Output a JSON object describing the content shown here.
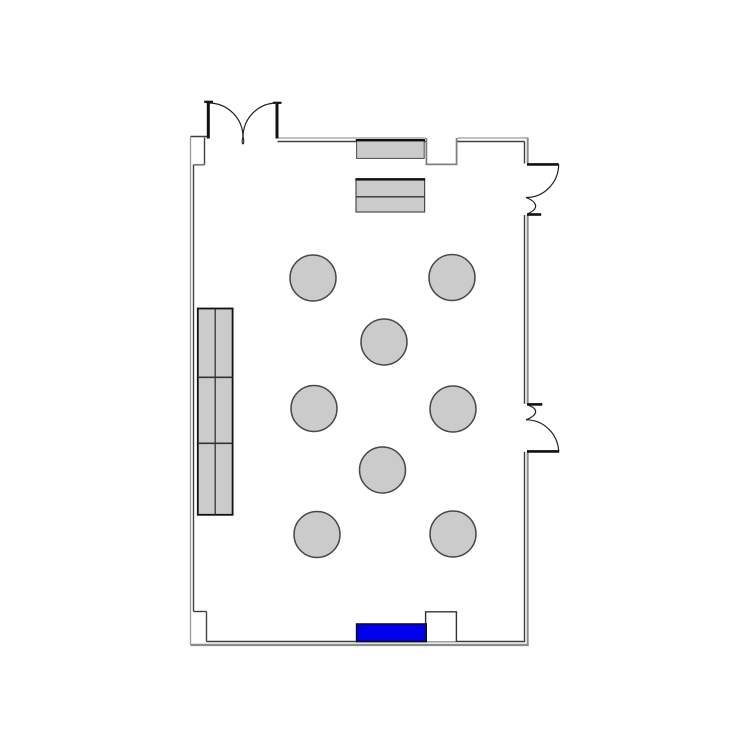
{
  "canvas": {
    "width": 750,
    "height": 750,
    "background": "#ffffff"
  },
  "colors": {
    "wall_dark": "#3f3f3f",
    "wall_outer": "#9a9a9a",
    "wall_outer_thick": "#8b8b8b",
    "notch_gray": "#808080",
    "edge_black": "#111111",
    "door_stroke": "#222222",
    "furniture_fill": "#cbcbcb",
    "furniture_stroke": "#4a4a4a",
    "divider": "#333333",
    "highlight_blue": "#0000ec",
    "white": "#ffffff"
  },
  "plan": {
    "elements": [
      {
        "name": "wall-left-outer",
        "kind": "line",
        "interactable": false,
        "attrs": {
          "x1": 190.5,
          "y1": 136.5,
          "x2": 190.5,
          "y2": 644.8,
          "stroke": "$wall_outer",
          "stroke-width": 1.3
        }
      },
      {
        "name": "wall-top-step-cap",
        "kind": "line",
        "interactable": false,
        "attrs": {
          "x1": 190.5,
          "y1": 136.5,
          "x2": 207.5,
          "y2": 136.5,
          "stroke": "$wall_dark",
          "stroke-width": 1.4
        }
      },
      {
        "name": "wall-top-step-inner-vertical",
        "kind": "line",
        "interactable": false,
        "attrs": {
          "x1": 204.5,
          "y1": 137.5,
          "x2": 204.5,
          "y2": 164.8,
          "stroke": "$wall_dark",
          "stroke-width": 1.4
        }
      },
      {
        "name": "wall-top-step-inner-horizontal",
        "kind": "line",
        "interactable": false,
        "attrs": {
          "x1": 193.5,
          "y1": 164.8,
          "x2": 204.5,
          "y2": 164.8,
          "stroke": "$notch_gray",
          "stroke-width": 1.8
        }
      },
      {
        "name": "wall-left-inner",
        "kind": "line",
        "interactable": false,
        "attrs": {
          "x1": 193.5,
          "y1": 164.8,
          "x2": 193.5,
          "y2": 611.5,
          "stroke": "$wall_dark",
          "stroke-width": 1.4
        }
      },
      {
        "name": "wall-bottom-step-horizontal",
        "kind": "line",
        "interactable": false,
        "attrs": {
          "x1": 193.5,
          "y1": 611.5,
          "x2": 206.5,
          "y2": 611.5,
          "stroke": "$wall_dark",
          "stroke-width": 1.4
        }
      },
      {
        "name": "wall-bottom-step-vertical",
        "kind": "line",
        "interactable": false,
        "attrs": {
          "x1": 206.5,
          "y1": 611.5,
          "x2": 206.5,
          "y2": 641.5,
          "stroke": "$wall_dark",
          "stroke-width": 1.4
        }
      },
      {
        "name": "wall-bottom-inner",
        "kind": "line",
        "interactable": false,
        "attrs": {
          "x1": 206.5,
          "y1": 641.5,
          "x2": 525.2,
          "y2": 641.5,
          "stroke": "$wall_dark",
          "stroke-width": 1.4
        }
      },
      {
        "name": "wall-bottom-outer",
        "kind": "line",
        "interactable": false,
        "attrs": {
          "x1": 190.5,
          "y1": 644.9,
          "x2": 528.7,
          "y2": 644.9,
          "stroke": "$wall_outer_thick",
          "stroke-width": 2.4
        }
      },
      {
        "name": "wall-top-outer-left-span",
        "kind": "line",
        "interactable": false,
        "attrs": {
          "x1": 277.5,
          "y1": 138.0,
          "x2": 425.5,
          "y2": 138.0,
          "stroke": "$wall_outer",
          "stroke-width": 1.3
        }
      },
      {
        "name": "wall-top-outer-right-span",
        "kind": "line",
        "interactable": false,
        "attrs": {
          "x1": 457.5,
          "y1": 138.0,
          "x2": 528.6,
          "y2": 138.0,
          "stroke": "$wall_outer",
          "stroke-width": 1.3
        }
      },
      {
        "name": "wall-top-inner-left-span",
        "kind": "line",
        "interactable": false,
        "attrs": {
          "x1": 277.5,
          "y1": 141.5,
          "x2": 425.5,
          "y2": 141.5,
          "stroke": "$wall_dark",
          "stroke-width": 1.4
        }
      },
      {
        "name": "wall-top-inner-right-span",
        "kind": "line",
        "interactable": false,
        "attrs": {
          "x1": 457.5,
          "y1": 141.5,
          "x2": 524.5,
          "y2": 141.5,
          "stroke": "$wall_dark",
          "stroke-width": 1.4
        }
      },
      {
        "name": "wall-right-inner-upper",
        "kind": "line",
        "interactable": false,
        "attrs": {
          "x1": 524.5,
          "y1": 141.5,
          "x2": 524.5,
          "y2": 163.5,
          "stroke": "$wall_dark",
          "stroke-width": 1.4
        }
      },
      {
        "name": "wall-right-inner-middle",
        "kind": "line",
        "interactable": false,
        "attrs": {
          "x1": 524.5,
          "y1": 215.0,
          "x2": 524.5,
          "y2": 403.8,
          "stroke": "$wall_dark",
          "stroke-width": 1.4
        }
      },
      {
        "name": "wall-right-inner-lower",
        "kind": "line",
        "interactable": false,
        "attrs": {
          "x1": 524.5,
          "y1": 451.8,
          "x2": 524.5,
          "y2": 641.5,
          "stroke": "$wall_dark",
          "stroke-width": 1.4
        }
      },
      {
        "name": "wall-right-outer-upper",
        "kind": "line",
        "interactable": false,
        "attrs": {
          "x1": 527.7,
          "y1": 138.0,
          "x2": 527.7,
          "y2": 163.5,
          "stroke": "$wall_outer_thick",
          "stroke-width": 2.0
        }
      },
      {
        "name": "wall-right-outer-middle",
        "kind": "line",
        "interactable": false,
        "attrs": {
          "x1": 527.7,
          "y1": 215.0,
          "x2": 527.7,
          "y2": 403.8,
          "stroke": "$wall_outer_thick",
          "stroke-width": 2.0
        }
      },
      {
        "name": "wall-right-outer-lower",
        "kind": "line",
        "interactable": false,
        "attrs": {
          "x1": 527.7,
          "y1": 451.8,
          "x2": 527.7,
          "y2": 644.9,
          "stroke": "$wall_outer_thick",
          "stroke-width": 2.0
        }
      },
      {
        "name": "wall-notch-top",
        "kind": "path",
        "interactable": false,
        "attrs": {
          "d": "M 426.4,138 L 426.4,164.4 L 456.6,164.4 L 456.6,138",
          "fill": "$white",
          "stroke": "$notch_gray",
          "stroke-width": 1.8
        }
      },
      {
        "name": "wall-notch-bottom",
        "kind": "path",
        "interactable": false,
        "attrs": {
          "d": "M 425.6,641.5 L 425.6,611.8 L 456.4,611.8 L 456.4,641.5",
          "fill": "$white",
          "stroke": "$divider",
          "stroke-width": 1.4
        }
      },
      {
        "name": "double-door-left-jamb",
        "kind": "line",
        "interactable": true,
        "attrs": {
          "x1": 208.3,
          "y1": 101.5,
          "x2": 208.3,
          "y2": 138.5,
          "stroke": "$edge_black",
          "stroke-width": 3.0
        }
      },
      {
        "name": "double-door-left-jamb-cap",
        "kind": "line",
        "interactable": false,
        "attrs": {
          "x1": 204.2,
          "y1": 101.8,
          "x2": 213.0,
          "y2": 101.8,
          "stroke": "$edge_black",
          "stroke-width": 2.2
        }
      },
      {
        "name": "double-door-right-jamb",
        "kind": "line",
        "interactable": true,
        "attrs": {
          "x1": 277.0,
          "y1": 102.5,
          "x2": 277.0,
          "y2": 138.5,
          "stroke": "$edge_black",
          "stroke-width": 3.0
        }
      },
      {
        "name": "double-door-right-jamb-cap",
        "kind": "line",
        "interactable": false,
        "attrs": {
          "x1": 272.8,
          "y1": 102.8,
          "x2": 281.5,
          "y2": 102.8,
          "stroke": "$edge_black",
          "stroke-width": 2.2
        }
      },
      {
        "name": "double-door-left-swing-arc",
        "kind": "path",
        "interactable": false,
        "attrs": {
          "d": "M 208.5,103 A 34.5,34 0 0 1 243,137",
          "fill": "none",
          "stroke": "$door_stroke",
          "stroke-width": 1.2
        }
      },
      {
        "name": "double-door-right-swing-arc",
        "kind": "path",
        "interactable": false,
        "attrs": {
          "d": "M 277,103 A 34,34 0 0 0 243,137",
          "fill": "none",
          "stroke": "$door_stroke",
          "stroke-width": 1.2
        }
      },
      {
        "name": "double-door-cusp-tail-left",
        "kind": "path",
        "interactable": false,
        "attrs": {
          "d": "M 243,136.5 Q 241.7,140.5 242.5,144.2",
          "fill": "none",
          "stroke": "$door_stroke",
          "stroke-width": 1.1
        }
      },
      {
        "name": "double-door-cusp-tail-right",
        "kind": "path",
        "interactable": false,
        "attrs": {
          "d": "M 243,136.5 Q 244.3,140.5 243.3,144.2",
          "fill": "none",
          "stroke": "$door_stroke",
          "stroke-width": 1.1
        }
      },
      {
        "name": "door-upper-right-leaf",
        "kind": "line",
        "interactable": true,
        "attrs": {
          "x1": 527.0,
          "y1": 164.4,
          "x2": 558.7,
          "y2": 164.4,
          "stroke": "$edge_black",
          "stroke-width": 2.6
        }
      },
      {
        "name": "door-upper-right-swing-arc",
        "kind": "path",
        "interactable": false,
        "attrs": {
          "d": "M 558.7,164.4 A 32.5,33.5 0 0 1 526,197.5",
          "fill": "none",
          "stroke": "$door_stroke",
          "stroke-width": 1.2
        }
      },
      {
        "name": "door-upper-right-hook",
        "kind": "path",
        "interactable": false,
        "attrs": {
          "d": "M 526,197.5 C 536.5,201.5 540,208 528.3,213.6",
          "fill": "none",
          "stroke": "$door_stroke",
          "stroke-width": 1.2
        }
      },
      {
        "name": "door-upper-right-jamb-cap",
        "kind": "line",
        "interactable": false,
        "attrs": {
          "x1": 527.0,
          "y1": 214.5,
          "x2": 541.2,
          "y2": 214.5,
          "stroke": "$edge_black",
          "stroke-width": 2.6
        }
      },
      {
        "name": "door-lower-right-jamb-cap",
        "kind": "line",
        "interactable": false,
        "attrs": {
          "x1": 527.0,
          "y1": 404.4,
          "x2": 542.3,
          "y2": 404.4,
          "stroke": "$edge_black",
          "stroke-width": 2.6
        }
      },
      {
        "name": "door-lower-right-hook",
        "kind": "path",
        "interactable": false,
        "attrs": {
          "d": "M 526,419.8 C 536.5,415.8 540,409.5 528.3,405.2",
          "fill": "none",
          "stroke": "$door_stroke",
          "stroke-width": 1.2
        }
      },
      {
        "name": "door-lower-right-swing-arc",
        "kind": "path",
        "interactable": false,
        "attrs": {
          "d": "M 558.7,451 A 32.5,33.5 0 0 0 526,419.8",
          "fill": "none",
          "stroke": "$door_stroke",
          "stroke-width": 1.2
        }
      },
      {
        "name": "door-lower-right-leaf",
        "kind": "line",
        "interactable": true,
        "attrs": {
          "x1": 527.0,
          "y1": 451.4,
          "x2": 559.2,
          "y2": 451.4,
          "stroke": "$edge_black",
          "stroke-width": 2.6
        }
      },
      {
        "name": "shelf-unit-left",
        "kind": "rect",
        "interactable": true,
        "attrs": {
          "x": 197.8,
          "y": 308.5,
          "width": 34.8,
          "height": 206.3,
          "fill": "$furniture_fill",
          "stroke": "$edge_black",
          "stroke-width": 1.8
        }
      },
      {
        "name": "shelf-unit-left-divider-vertical",
        "kind": "line",
        "interactable": false,
        "attrs": {
          "x1": 215.2,
          "y1": 309.0,
          "x2": 215.2,
          "y2": 514.5,
          "stroke": "$divider",
          "stroke-width": 1.3
        }
      },
      {
        "name": "shelf-unit-left-divider-h1",
        "kind": "line",
        "interactable": false,
        "attrs": {
          "x1": 198.0,
          "y1": 377.3,
          "x2": 232.6,
          "y2": 377.3,
          "stroke": "$divider",
          "stroke-width": 1.6
        }
      },
      {
        "name": "shelf-unit-left-divider-h2",
        "kind": "line",
        "interactable": false,
        "attrs": {
          "x1": 198.0,
          "y1": 443.3,
          "x2": 232.6,
          "y2": 443.3,
          "stroke": "$divider",
          "stroke-width": 1.6
        }
      },
      {
        "name": "counter-top-wall",
        "kind": "rect",
        "interactable": true,
        "attrs": {
          "x": 356.6,
          "y": 140.8,
          "width": 67.6,
          "height": 17.6,
          "fill": "$furniture_fill",
          "stroke": "$furniture_stroke",
          "stroke-width": 1.0
        }
      },
      {
        "name": "counter-top-wall-edge",
        "kind": "line",
        "interactable": false,
        "attrs": {
          "x1": 355.8,
          "y1": 140.2,
          "x2": 425.0,
          "y2": 140.2,
          "stroke": "$edge_black",
          "stroke-width": 2.4
        }
      },
      {
        "name": "cabinet-freestanding",
        "kind": "rect",
        "interactable": true,
        "attrs": {
          "x": 356.0,
          "y": 180.0,
          "width": 68.6,
          "height": 32.0,
          "fill": "$furniture_fill",
          "stroke": "$furniture_stroke",
          "stroke-width": 1.2
        }
      },
      {
        "name": "cabinet-freestanding-edge",
        "kind": "line",
        "interactable": false,
        "attrs": {
          "x1": 355.4,
          "y1": 179.3,
          "x2": 425.2,
          "y2": 179.3,
          "stroke": "$edge_black",
          "stroke-width": 2.4
        }
      },
      {
        "name": "cabinet-freestanding-divider",
        "kind": "line",
        "interactable": false,
        "attrs": {
          "x1": 356.0,
          "y1": 196.8,
          "x2": 424.6,
          "y2": 196.8,
          "stroke": "$divider",
          "stroke-width": 1.3
        }
      },
      {
        "name": "table-1",
        "kind": "circle",
        "interactable": true,
        "attrs": {
          "cx": 313.0,
          "cy": 278.0,
          "r": 23,
          "fill": "$furniture_fill",
          "stroke": "$furniture_stroke",
          "stroke-width": 1.5
        }
      },
      {
        "name": "table-2",
        "kind": "circle",
        "interactable": true,
        "attrs": {
          "cx": 452.0,
          "cy": 277.5,
          "r": 23,
          "fill": "$furniture_fill",
          "stroke": "$furniture_stroke",
          "stroke-width": 1.5
        }
      },
      {
        "name": "table-3",
        "kind": "circle",
        "interactable": true,
        "attrs": {
          "cx": 384.0,
          "cy": 342.0,
          "r": 23,
          "fill": "$furniture_fill",
          "stroke": "$furniture_stroke",
          "stroke-width": 1.5
        }
      },
      {
        "name": "table-4",
        "kind": "circle",
        "interactable": true,
        "attrs": {
          "cx": 314.0,
          "cy": 408.5,
          "r": 23,
          "fill": "$furniture_fill",
          "stroke": "$furniture_stroke",
          "stroke-width": 1.5
        }
      },
      {
        "name": "table-5",
        "kind": "circle",
        "interactable": true,
        "attrs": {
          "cx": 453.0,
          "cy": 409.0,
          "r": 23,
          "fill": "$furniture_fill",
          "stroke": "$furniture_stroke",
          "stroke-width": 1.5
        }
      },
      {
        "name": "table-6",
        "kind": "circle",
        "interactable": true,
        "attrs": {
          "cx": 382.5,
          "cy": 470.0,
          "r": 23,
          "fill": "$furniture_fill",
          "stroke": "$furniture_stroke",
          "stroke-width": 1.5
        }
      },
      {
        "name": "table-7",
        "kind": "circle",
        "interactable": true,
        "attrs": {
          "cx": 317.0,
          "cy": 534.5,
          "r": 23,
          "fill": "$furniture_fill",
          "stroke": "$furniture_stroke",
          "stroke-width": 1.5
        }
      },
      {
        "name": "table-8",
        "kind": "circle",
        "interactable": true,
        "attrs": {
          "cx": 453.0,
          "cy": 534.0,
          "r": 23,
          "fill": "$furniture_fill",
          "stroke": "$furniture_stroke",
          "stroke-width": 1.5
        }
      },
      {
        "name": "highlighted-unit-blue",
        "kind": "rect",
        "interactable": true,
        "attrs": {
          "x": 356.6,
          "y": 624.0,
          "width": 69.6,
          "height": 17.6,
          "fill": "$highlight_blue",
          "stroke": "$edge_black",
          "stroke-width": 1.6
        }
      }
    ]
  }
}
